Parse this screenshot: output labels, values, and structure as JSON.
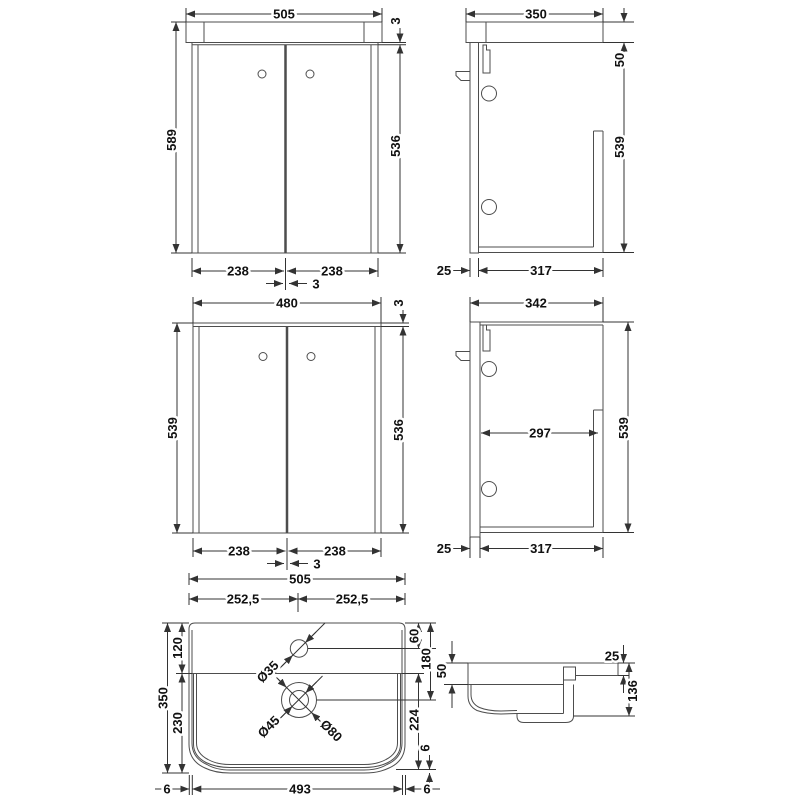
{
  "views": {
    "front_with_basin": {
      "overall_width": "505",
      "basin_door_gap": "3",
      "overall_height": "589",
      "door_height": "536",
      "left_door_width": "238",
      "right_door_width": "238",
      "door_gap": "3"
    },
    "side_with_basin": {
      "depth": "350",
      "basin_height": "50",
      "cabinet_height": "539",
      "door_setback": "25",
      "body_depth": "317"
    },
    "front_carcass": {
      "width": "480",
      "top_gap": "3",
      "height": "539",
      "door_height": "536",
      "left_door_width": "238",
      "right_door_width": "238",
      "door_gap": "3"
    },
    "side_carcass": {
      "depth": "342",
      "internal_depth": "297",
      "height": "539",
      "door_setback": "25",
      "body_depth": "317"
    },
    "basin_plan": {
      "width": "505",
      "left_half": "252,5",
      "right_half": "252,5",
      "depth": "350",
      "back_depth": "120",
      "bowl_depth": "230",
      "tap_centre_offset": "60",
      "waste_centre_offset": "180",
      "bowl_inner_depth": "224",
      "front_rim": "6",
      "left_rim": "6",
      "bottom_width": "493",
      "right_rim": "6",
      "tap_hole_diameter": "Ø35",
      "waste_diameter": "Ø45",
      "overflow_diameter": "Ø80"
    },
    "basin_profile": {
      "front_height": "50",
      "rear_ledge_thickness": "25",
      "overall_height": "136"
    }
  }
}
